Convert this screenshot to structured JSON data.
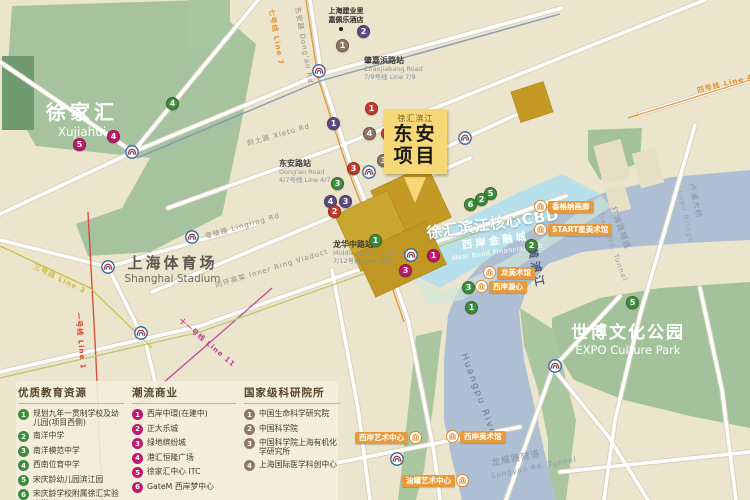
{
  "palette": {
    "green": "#3e8c3e",
    "magenta": "#bf1870",
    "taupe": "#8d7766",
    "purple": "#5d4a85",
    "red": "#c23b30",
    "badge_orange": "#e59b3c",
    "gold": "#c49a25",
    "river": "#aebfd4",
    "cbd_blue": "#b5dfeb",
    "park_green": "#a6c29e"
  },
  "callout": {
    "tag": "徐汇滨江",
    "line1": "东安",
    "line2": "项目"
  },
  "areas": {
    "xujiahui": {
      "zh": "徐家汇",
      "en": "Xujiahui"
    },
    "stadium": {
      "zh": "上海体育场",
      "en": "Shanghai Stadium"
    },
    "expo": {
      "zh": "世博文化公园",
      "en": "EXPO Culture Park"
    },
    "cbd": {
      "zh": "徐汇滨江核心CBD"
    },
    "financial": {
      "zh": "西岸金融城",
      "en": "West Bund Financial Hub"
    },
    "river": {
      "zh": "黄浦江",
      "en": "Huangpu River"
    },
    "hotel": {
      "line1": "上海建业里",
      "line2": "嘉佩乐酒店"
    }
  },
  "stations": [
    {
      "zh": "肇嘉浜路站",
      "en": "Zhaojiabang Road",
      "line": "7/9号线 Line 7/9",
      "x": 364,
      "y": 56
    },
    {
      "zh": "东安路站",
      "en": "Dong'an Road",
      "line": "4/7号线 Line 4/7",
      "x": 279,
      "y": 159
    },
    {
      "zh": "龙华中路站",
      "en": "Middle Longhua Road",
      "line": "7/12号线 Line 7/12",
      "x": 333,
      "y": 240
    }
  ],
  "road_labels": [
    {
      "text": "斜土路 Xietu Rd",
      "x": 246,
      "y": 139,
      "rot": -16,
      "color": "#958c7a"
    },
    {
      "text": "零陵路 Lingling Rd",
      "x": 204,
      "y": 232,
      "rot": -16,
      "color": "#958c7a"
    },
    {
      "text": "内环高架 Inner Ring Viaduct",
      "x": 214,
      "y": 281,
      "rot": -17,
      "color": "#958c7a"
    },
    {
      "text": "东安路 Dong'an Rd",
      "x": 302,
      "y": 6,
      "rot": 80,
      "color": "#958c7a"
    },
    {
      "text": "龙耀路隧道",
      "x": 490,
      "y": 456,
      "rot": -11,
      "color": "#8a93a5",
      "size": 9
    },
    {
      "text": "Longyao Rd. Tunnel",
      "x": 491,
      "y": 472,
      "rot": -11,
      "color": "#8a93a5"
    },
    {
      "text": "打浦路隧道",
      "x": 618,
      "y": 205,
      "rot": 70,
      "color": "#8a93a5",
      "size": 8
    },
    {
      "text": "Dapu Rd. Tunnel",
      "x": 604,
      "y": 212,
      "rot": 70,
      "color": "#9aa2b2"
    },
    {
      "text": "卢浦大桥",
      "x": 697,
      "y": 182,
      "rot": 78,
      "color": "#8a93a5",
      "size": 8
    },
    {
      "text": "Lupu Bridge",
      "x": 684,
      "y": 190,
      "rot": 78,
      "color": "#9aa2b2"
    }
  ],
  "metro_line_labels": [
    {
      "text": "七号线 Line 7",
      "x": 276,
      "y": 8,
      "rot": 80,
      "color": "#e2912f"
    },
    {
      "text": "三号线 Line 3",
      "x": 36,
      "y": 262,
      "rot": 26,
      "color": "#cbbd3c"
    },
    {
      "text": "一号线 Line 1",
      "x": 83,
      "y": 312,
      "rot": 85,
      "color": "#cf4433"
    },
    {
      "text": "十一号线 Line 11",
      "x": 183,
      "y": 316,
      "rot": 40,
      "color": "#bf3f8f"
    },
    {
      "text": "四号线 Line 4",
      "x": 696,
      "y": 86,
      "rot": -14,
      "color": "#e2912f"
    }
  ],
  "markers": [
    {
      "n": "2",
      "color": "purple",
      "x": 363,
      "y": 31
    },
    {
      "n": "1",
      "color": "taupe",
      "x": 342,
      "y": 45
    },
    {
      "n": "1",
      "color": "red",
      "x": 371,
      "y": 108
    },
    {
      "n": "1",
      "color": "purple",
      "x": 333,
      "y": 123
    },
    {
      "n": "4",
      "color": "taupe",
      "x": 369,
      "y": 133
    },
    {
      "n": "2",
      "color": "red",
      "x": 387,
      "y": 133
    },
    {
      "n": "3",
      "color": "taupe",
      "x": 383,
      "y": 160
    },
    {
      "n": "3",
      "color": "red",
      "x": 353,
      "y": 168
    },
    {
      "n": "3",
      "color": "green",
      "x": 337,
      "y": 183
    },
    {
      "n": "4",
      "color": "purple",
      "x": 330,
      "y": 201
    },
    {
      "n": "3",
      "color": "purple",
      "x": 345,
      "y": 201
    },
    {
      "n": "2",
      "color": "red",
      "x": 334,
      "y": 211
    },
    {
      "n": "1",
      "color": "green",
      "x": 375,
      "y": 240
    },
    {
      "n": "4",
      "color": "green",
      "x": 172,
      "y": 103
    },
    {
      "n": "4",
      "color": "magenta",
      "x": 113,
      "y": 136
    },
    {
      "n": "5",
      "color": "magenta",
      "x": 79,
      "y": 144
    },
    {
      "n": "1",
      "color": "magenta",
      "x": 433,
      "y": 255
    },
    {
      "n": "3",
      "color": "magenta",
      "x": 405,
      "y": 270
    },
    {
      "n": "5",
      "color": "green",
      "x": 490,
      "y": 193
    },
    {
      "n": "2",
      "color": "green",
      "x": 481,
      "y": 199
    },
    {
      "n": "6",
      "color": "green",
      "x": 470,
      "y": 204
    },
    {
      "n": "2",
      "color": "green",
      "x": 531,
      "y": 245
    },
    {
      "n": "3",
      "color": "green",
      "x": 468,
      "y": 287
    },
    {
      "n": "1",
      "color": "green",
      "x": 471,
      "y": 307
    },
    {
      "n": "5",
      "color": "green",
      "x": 632,
      "y": 302
    }
  ],
  "metro_icons": [
    {
      "x": 132,
      "y": 152
    },
    {
      "x": 108,
      "y": 267
    },
    {
      "x": 192,
      "y": 237
    },
    {
      "x": 141,
      "y": 333
    },
    {
      "x": 319,
      "y": 71
    },
    {
      "x": 369,
      "y": 172
    },
    {
      "x": 411,
      "y": 255
    },
    {
      "x": 465,
      "y": 138
    },
    {
      "x": 555,
      "y": 366
    },
    {
      "x": 397,
      "y": 459
    }
  ],
  "badges": [
    {
      "text": "香格纳画廊",
      "x": 533,
      "y": 200,
      "icon": "left"
    },
    {
      "text": "START星美术馆",
      "x": 533,
      "y": 223,
      "icon": "left"
    },
    {
      "text": "龙美术馆",
      "x": 482,
      "y": 266,
      "icon": "left"
    },
    {
      "text": "西岸漩心",
      "x": 474,
      "y": 280,
      "icon": "left"
    },
    {
      "text": "西岸艺术中心",
      "x": 355,
      "y": 431,
      "icon": "right"
    },
    {
      "text": "西岸美术馆",
      "x": 445,
      "y": 430,
      "icon": "left"
    },
    {
      "text": "油罐艺术中心",
      "x": 402,
      "y": 474,
      "icon": "right"
    }
  ],
  "legend": {
    "columns": [
      {
        "title": "优质教育资源",
        "color": "green",
        "items": [
          "规划九年一贯制学校及幼儿园(项目西侧)",
          "南洋中学",
          "南洋模范中学",
          "西南位育中学",
          "宋庆龄幼儿园滨江园",
          "宋庆龄学校附属徐汇实验小学"
        ]
      },
      {
        "title": "潮流商业",
        "color": "magenta",
        "items": [
          "西岸中環(在建中)",
          "正大乐城",
          "绿地缤纷城",
          "港汇恒隆广场",
          "徐家汇中心 ITC",
          "GateM 西岸梦中心"
        ]
      },
      {
        "title": "国家级科研院所",
        "color": "taupe",
        "items": [
          "中国生命科学研究院",
          "中国科学院",
          "中国科学院上海有机化学研究所",
          "上海国际医学科创中心"
        ]
      }
    ]
  }
}
